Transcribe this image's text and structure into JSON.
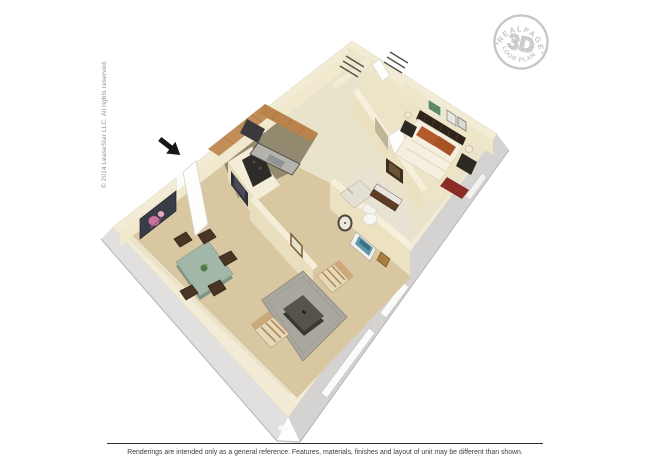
{
  "page": {
    "width": 650,
    "height": 466,
    "background": "#ffffff",
    "description": "3D isometric floor plan rendering of a one-bedroom apartment"
  },
  "watermark": {
    "arc_top": "REALPAGE",
    "center": "3D",
    "arc_bottom": "FLOOR PLANS",
    "separator": "✦",
    "color": "#c5c5c3"
  },
  "copyright_vertical": "© 2014 LeaseStar LLC. All rights reserved.",
  "footer": {
    "disclaimer": "Renderings are intended only as a general reference. Features, materials, finishes and layout of unit may be different than shown."
  },
  "floor_plan": {
    "colors": {
      "exterior_wall_se": "#d4d3d1",
      "exterior_wall_sw": "#e1e0de",
      "exterior_wall_ne": "#efeeec",
      "wall_top": "#f2ecd6",
      "wall_face": "#ece2c2",
      "carpet": "#d8c7a0",
      "bedroom_carpet": "#ece4c6",
      "kitchen_tile": "#93896f",
      "hall_tile": "#eae3cb",
      "cabinet_wood": "#c28d58",
      "counter_dark": "#2e2b29",
      "dining_table": "#a3b7a8",
      "chair_wood": "#4a3423",
      "rug_gray": "#aaa89e",
      "rug_red": "#8c2c26",
      "pillow_orange": "#b25a2b",
      "flower_art_pink": "#cf6f9e",
      "art_green": "#5d8a5e",
      "arrow_black": "#161616"
    }
  }
}
